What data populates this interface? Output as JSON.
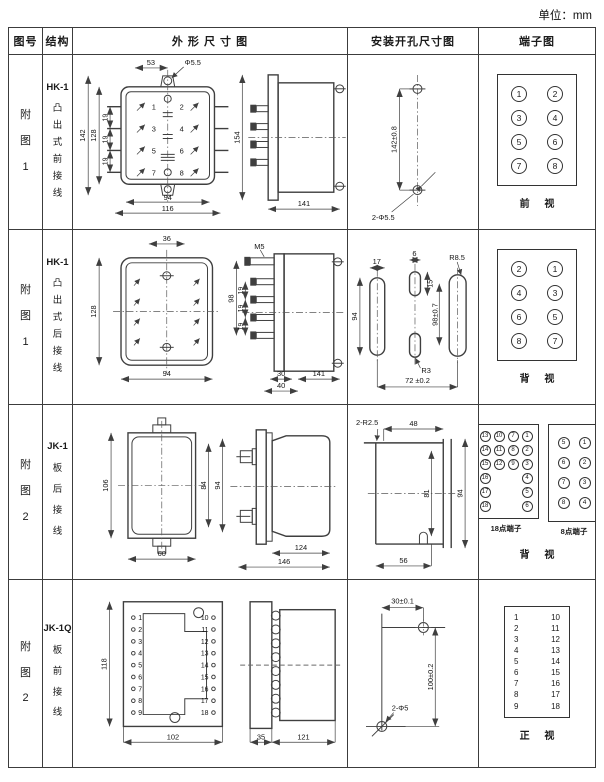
{
  "unit_note": "单位：mm",
  "header": {
    "figure": "图号",
    "structure": "结构",
    "outline": "外 形 尺 寸 图",
    "mounting": "安装开孔尺寸图",
    "terminal": "端子图"
  },
  "rows": [
    {
      "figure": "附图1",
      "model": "HK-1",
      "structure": "凸出式前接线",
      "outline": {
        "dim_top": "53",
        "dim_hole": "Φ5.5",
        "dim_h_outer": "142",
        "dim_h_inner": "128",
        "pitch1": "19",
        "pitch2": "19",
        "pitch3": "19",
        "dim_w_inner": "94",
        "dim_w_outer": "116",
        "t1": "1",
        "t2": "2",
        "t3": "3",
        "t4": "4",
        "t5": "5",
        "t6": "6",
        "t7": "7",
        "t8": "8",
        "side_h": "154",
        "side_d": "141"
      },
      "mounting": {
        "dim_v": "142±0.8",
        "holes": "2-Φ5.5"
      },
      "terminal": {
        "cells": [
          [
            "1",
            "2"
          ],
          [
            "3",
            "4"
          ],
          [
            "5",
            "6"
          ],
          [
            "7",
            "8"
          ]
        ],
        "view": "前 视"
      }
    },
    {
      "figure": "附图1",
      "model": "HK-1",
      "structure": "凸出式后接线",
      "outline": {
        "dim_top": "36",
        "dim_h": "128",
        "dim_w": "94",
        "thread": "M5",
        "side_h": "98",
        "pitch1": "19",
        "pitch2": "19",
        "pitch3": "19",
        "dim_30": "30",
        "dim_40": "40",
        "side_d": "141"
      },
      "mounting": {
        "d17": "17",
        "d6": "6",
        "d15": "15",
        "d94": "94",
        "d98": "98±0.7",
        "r85": "R8.5",
        "r3": "R3",
        "d72": "72 ±0.2"
      },
      "terminal": {
        "cells": [
          [
            "2",
            "1"
          ],
          [
            "4",
            "3"
          ],
          [
            "6",
            "5"
          ],
          [
            "8",
            "7"
          ]
        ],
        "view": "背 视"
      }
    },
    {
      "figure": "附图2",
      "model": "JK-1",
      "structure": "板后接线",
      "outline": {
        "dim_h": "106",
        "dim_h_in": "84",
        "dim_h_out": "94",
        "dim_w": "60",
        "side_d1": "124",
        "side_d2": "146"
      },
      "mounting": {
        "r25": "2-R2.5",
        "d48": "48",
        "d81": "81",
        "d94": "94",
        "d56": "56"
      },
      "terminal": {
        "grid18": [
          [
            "13",
            "10",
            "7",
            "1"
          ],
          [
            "14",
            "11",
            "8",
            "2"
          ],
          [
            "15",
            "12",
            "9",
            "3"
          ],
          [
            "16",
            "",
            "",
            "4"
          ],
          [
            "17",
            "",
            "",
            "5"
          ],
          [
            "18",
            "",
            "",
            "6"
          ]
        ],
        "grid8": [
          [
            "5",
            "1"
          ],
          [
            "6",
            "2"
          ],
          [
            "7",
            "3"
          ],
          [
            "8",
            "4"
          ]
        ],
        "label18": "18点端子",
        "label8": "8点端子",
        "view": "背 视"
      }
    },
    {
      "figure": "附图2",
      "model": "JK-1Q",
      "structure": "板前接线",
      "outline": {
        "dim_h": "118",
        "left": [
          "1",
          "2",
          "3",
          "4",
          "5",
          "6",
          "7",
          "8",
          "9"
        ],
        "right": [
          "10",
          "11",
          "12",
          "13",
          "14",
          "15",
          "16",
          "17",
          "18"
        ],
        "dim_w": "102",
        "side_d1": "35",
        "side_d2": "121"
      },
      "mounting": {
        "d30": "30±0.1",
        "d100": "100±0.2",
        "holes": "2-Φ5"
      },
      "terminal": {
        "left": [
          "1",
          "2",
          "3",
          "4",
          "5",
          "6",
          "7",
          "8",
          "9"
        ],
        "right": [
          "10",
          "11",
          "12",
          "13",
          "14",
          "15",
          "16",
          "17",
          "18"
        ],
        "view": "正 视"
      }
    }
  ]
}
